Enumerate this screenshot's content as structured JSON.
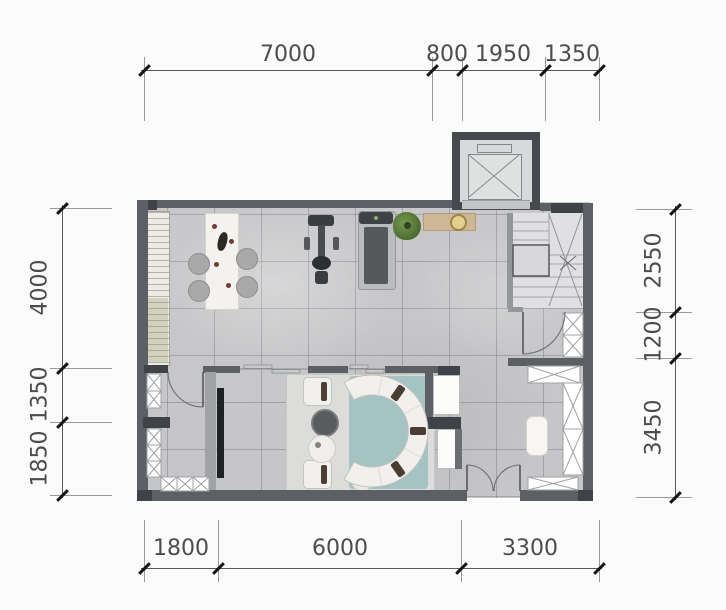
{
  "dims": {
    "top": [
      "7000",
      "800",
      "1950",
      "1350"
    ],
    "bottom": [
      "1800",
      "6000",
      "3300"
    ],
    "left": [
      "4000",
      "1350",
      "1850"
    ],
    "right": [
      "2550",
      "1200",
      "3450"
    ]
  },
  "colors": {
    "wall": "#5c6064",
    "wall_dark": "#3f4347",
    "floor": "#c8c8ca",
    "stair": "#e0e0e2",
    "rug_teal": "#a6c3c4",
    "area_rug": "#dcdcda",
    "sofa": "#f1f0ec",
    "wood_console": "#cdb795",
    "plant": "#5f8748",
    "dimension_text": "#4c4c4c"
  }
}
